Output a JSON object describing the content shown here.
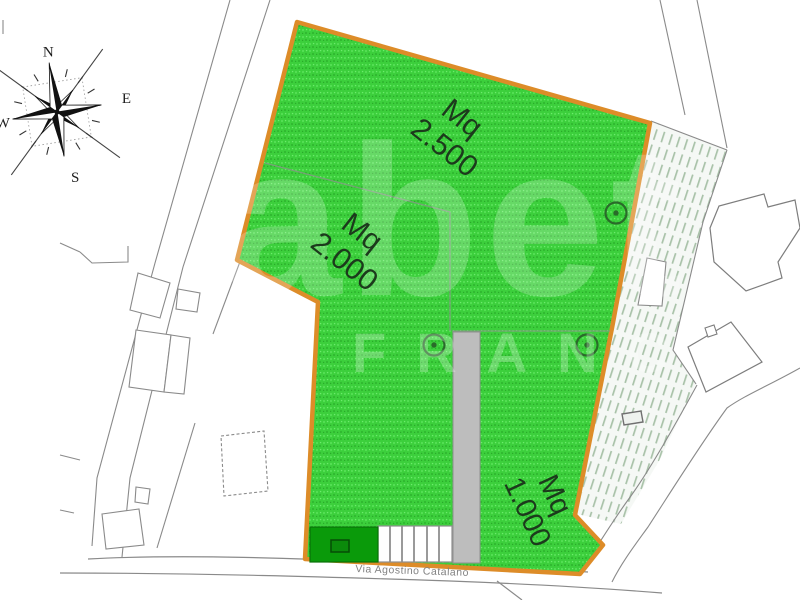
{
  "plan": {
    "type": "cadastral-site-plan",
    "street": {
      "name": "Via Agostino Catalano"
    },
    "parcels": [
      {
        "id": "lot-2500",
        "unit": "Mq",
        "area": "2.500"
      },
      {
        "id": "lot-2000",
        "unit": "Mq",
        "area": "2.000"
      },
      {
        "id": "lot-1000",
        "unit": "Mq",
        "area": "1.000"
      }
    ],
    "compass": {
      "north": "N",
      "east": "E",
      "south": "S",
      "west": "W"
    },
    "watermark": {
      "word1": "abet",
      "word2": "FRANC"
    },
    "tree_symbol_count": 3,
    "colors": {
      "parcel_green": "#3ccf3c",
      "dark_green_block": "#0a9a0a",
      "boundary_orange": "#dd8c28",
      "hatch_green_gray": "#a9c2a9",
      "cadastral_line_gray": "#8a8a8a",
      "driveway_gray": "#bdbdbd"
    }
  }
}
